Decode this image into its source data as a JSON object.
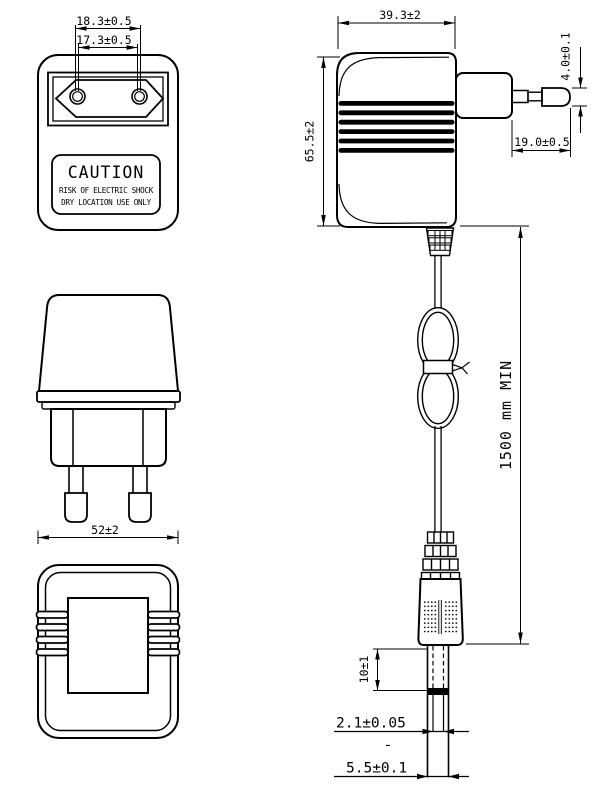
{
  "drawing_type": "AC adapter outline dimensional drawing",
  "front_view": {
    "dim_pin_spacing_outer": "18.3±0.5",
    "dim_pin_spacing_inner": "17.3±0.5",
    "caution_title": "CAUTION",
    "caution_line1": "RISK OF ELECTRIC SHOCK",
    "caution_line2": "DRY LOCATION USE ONLY"
  },
  "side_view": {
    "dim_body_width": "39.3±2",
    "dim_body_height": "65.5±2",
    "dim_pin_diameter": "4.0±0.1",
    "dim_pin_length": "19.0±0.5",
    "dim_cord_length": "1500 mm MIN"
  },
  "pin_side_view": {
    "dim_body_depth": "52±2"
  },
  "dc_plug_detail": {
    "dim_tip_length": "10±1",
    "dim_inner_diameter": "2.1±0.05",
    "dim_dash": "-",
    "dim_outer_diameter": "5.5±0.1"
  },
  "colors": {
    "line": "#000000",
    "background": "#ffffff",
    "rib_fill": "#000000"
  }
}
